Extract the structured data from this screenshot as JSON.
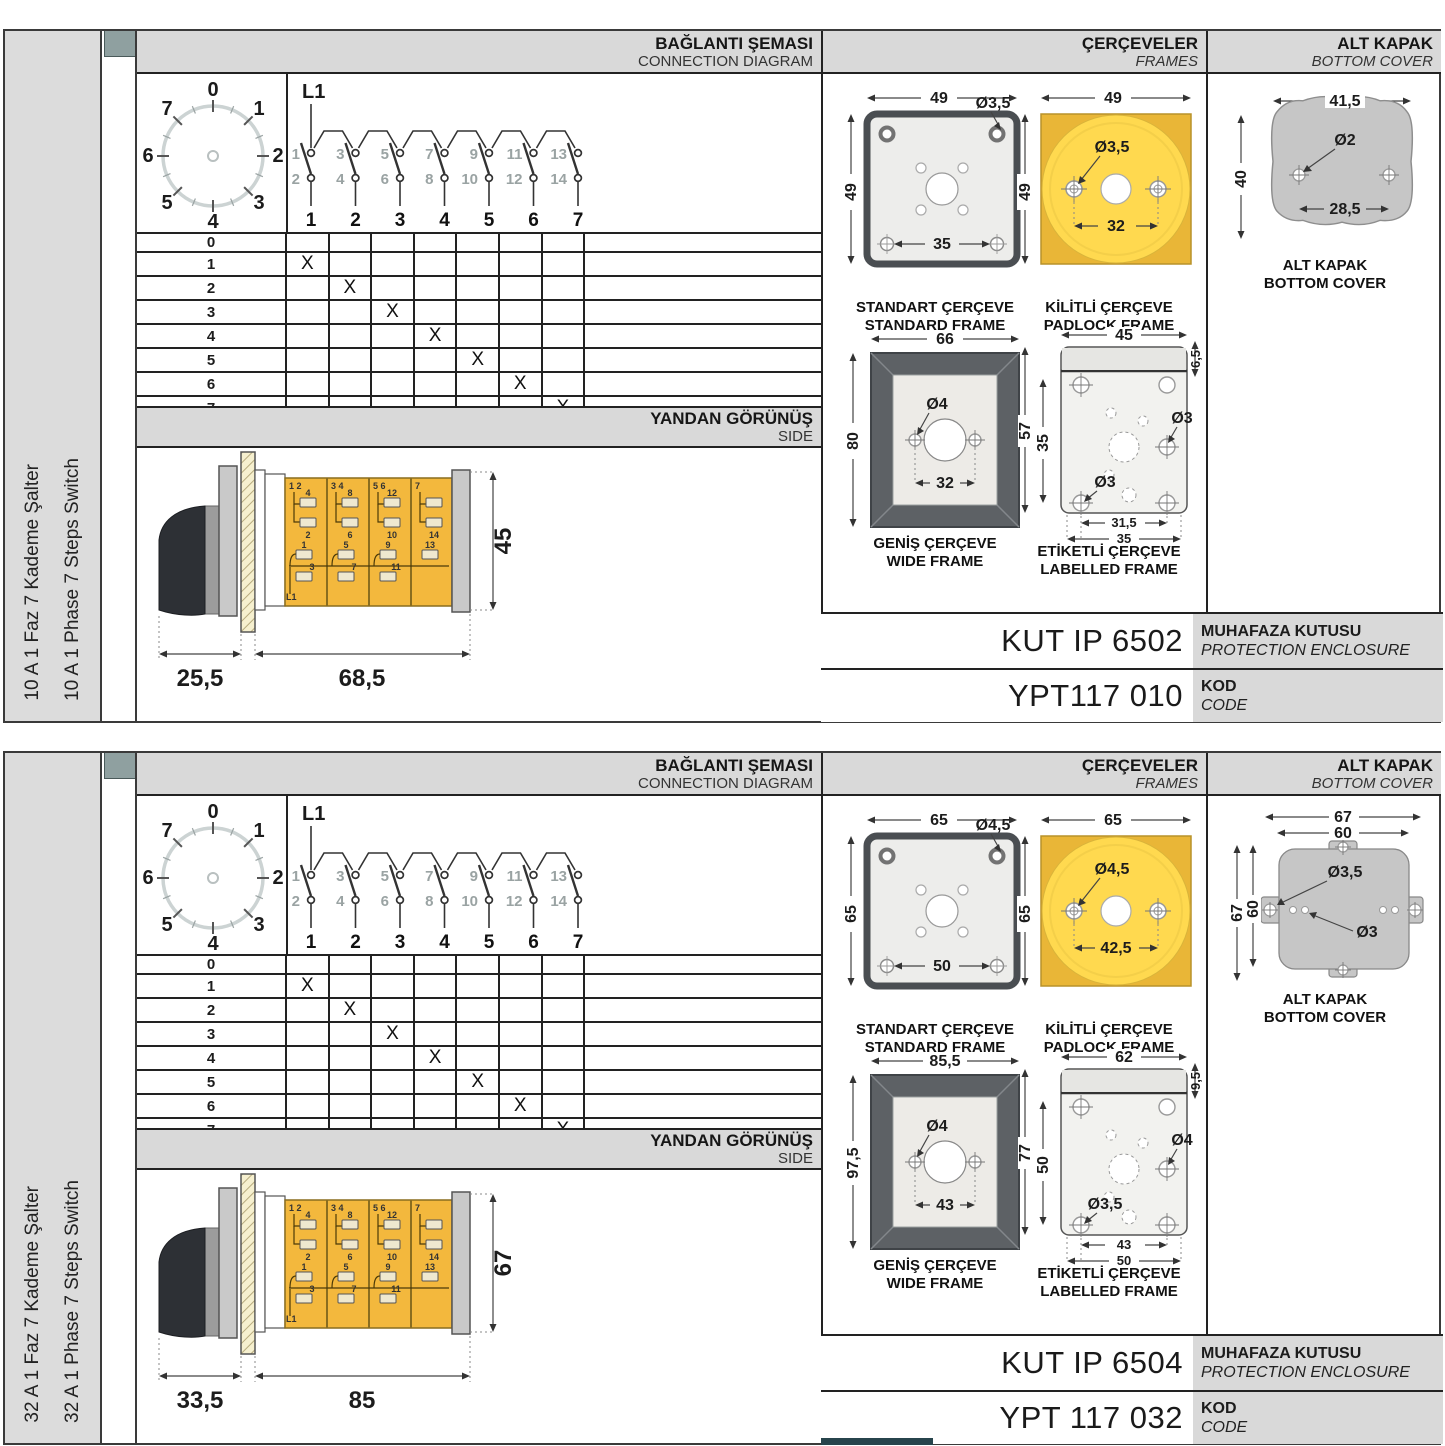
{
  "colors": {
    "header_gray": "#d9d9d9",
    "padlock_yellow": "#efc23a",
    "padlock_circle_yellow": "#ffd94f",
    "switch_body_yellow": "#f3b83d",
    "wide_frame_gray": "#5d6165",
    "cover_gray": "#c6c6c6",
    "tab_square_teal": "#8fa0a0"
  },
  "panels": [
    {
      "side_label_tr": "10 A 1 Faz 7 Kademe Şalter",
      "side_label_en": "10 A 1 Phase 7 Steps Switch",
      "headers": {
        "connection_tr": "BAĞLANTI ŞEMASI",
        "connection_en": "CONNECTION DIAGRAM",
        "frames_tr": "ÇERÇEVELER",
        "frames_en": "FRAMES",
        "cover_tr": "ALT KAPAK",
        "cover_en": "BOTTOM COVER",
        "side_tr": "YANDAN GÖRÜNÜŞ",
        "side_en": "SIDE"
      },
      "dial": {
        "positions": [
          "0",
          "1",
          "2",
          "3",
          "4",
          "5",
          "6",
          "7"
        ]
      },
      "circuit": {
        "feed": "L1",
        "top_terminals": [
          "1",
          "3",
          "5",
          "7",
          "9",
          "11",
          "13"
        ],
        "bottom_terminals": [
          "2",
          "4",
          "6",
          "8",
          "10",
          "12",
          "14"
        ],
        "columns": [
          "1",
          "2",
          "3",
          "4",
          "5",
          "6",
          "7"
        ]
      },
      "table": {
        "rows": [
          "0",
          "1",
          "2",
          "3",
          "4",
          "5",
          "6",
          "7"
        ],
        "mark": "X"
      },
      "side_view": {
        "dim_front": "25,5",
        "dim_body": "68,5",
        "dim_height": "45",
        "feed": "L1",
        "modules_top": [
          {
            "corner": "1 2",
            "upper": "4",
            "lower": "2"
          },
          {
            "corner": "3 4",
            "upper": "8",
            "lower": "6"
          },
          {
            "corner": "5 6",
            "upper": "12",
            "lower": "10"
          },
          {
            "corner": "7",
            "upper": "",
            "lower": "14"
          }
        ],
        "modules_bottom": [
          {
            "upper": "1",
            "lower": "3"
          },
          {
            "upper": "5",
            "lower": "7"
          },
          {
            "upper": "9",
            "lower": "11"
          },
          {
            "upper": "13",
            "lower": ""
          }
        ]
      },
      "standard_frame": {
        "caption_tr": "STANDART ÇERÇEVE",
        "caption_en": "STANDARD FRAME",
        "width": "49",
        "height": "49",
        "hole": "Ø3,5",
        "inner": "35"
      },
      "padlock_frame": {
        "caption_tr": "KİLİTLİ ÇERÇEVE",
        "caption_en": "PADLOCK FRAME",
        "width": "49",
        "height": "49",
        "hole": "Ø3,5",
        "inner": "32"
      },
      "wide_frame": {
        "caption_tr": "GENİŞ ÇERÇEVE",
        "caption_en": "WIDE FRAME",
        "width": "66",
        "height": "80",
        "hole": "Ø4",
        "inner": "32"
      },
      "labelled_frame": {
        "caption_tr": "ETİKETLİ ÇERÇEVE",
        "caption_en": "LABELLED FRAME",
        "width": "45",
        "strip": "6,5",
        "height": "57",
        "inner_height": "35",
        "hole_upper": "Ø3",
        "hole_lower": "Ø3",
        "inner_width": "31,5",
        "outer_width": "35"
      },
      "bottom_cover": {
        "caption_tr": "ALT KAPAK",
        "caption_en": "BOTTOM COVER",
        "width": "41,5",
        "hole": "Ø2",
        "height": "40",
        "inner": "28,5"
      },
      "codes": {
        "enclosure_value": "KUT IP 6502",
        "enclosure_tr": "MUHAFAZA KUTUSU",
        "enclosure_en": "PROTECTION ENCLOSURE",
        "code_value": "YPT117 010",
        "code_tr": "KOD",
        "code_en": "CODE"
      }
    },
    {
      "side_label_tr": "32 A 1 Faz 7 Kademe Şalter",
      "side_label_en": "32 A 1 Phase 7 Steps Switch",
      "headers": {
        "connection_tr": "BAĞLANTI ŞEMASI",
        "connection_en": "CONNECTION DIAGRAM",
        "frames_tr": "ÇERÇEVELER",
        "frames_en": "FRAMES",
        "cover_tr": "ALT KAPAK",
        "cover_en": "BOTTOM COVER",
        "side_tr": "YANDAN GÖRÜNÜŞ",
        "side_en": "SIDE"
      },
      "dial": {
        "positions": [
          "0",
          "1",
          "2",
          "3",
          "4",
          "5",
          "6",
          "7"
        ]
      },
      "circuit": {
        "feed": "L1",
        "top_terminals": [
          "1",
          "3",
          "5",
          "7",
          "9",
          "11",
          "13"
        ],
        "bottom_terminals": [
          "2",
          "4",
          "6",
          "8",
          "10",
          "12",
          "14"
        ],
        "columns": [
          "1",
          "2",
          "3",
          "4",
          "5",
          "6",
          "7"
        ]
      },
      "table": {
        "rows": [
          "0",
          "1",
          "2",
          "3",
          "4",
          "5",
          "6",
          "7"
        ],
        "mark": "X"
      },
      "side_view": {
        "dim_front": "33,5",
        "dim_body": "85",
        "dim_height": "67",
        "feed": "L1",
        "modules_top": [
          {
            "corner": "1 2",
            "upper": "4",
            "lower": "2"
          },
          {
            "corner": "3 4",
            "upper": "8",
            "lower": "6"
          },
          {
            "corner": "5 6",
            "upper": "12",
            "lower": "10"
          },
          {
            "corner": "7",
            "upper": "",
            "lower": "14"
          }
        ],
        "modules_bottom": [
          {
            "upper": "1",
            "lower": "3"
          },
          {
            "upper": "5",
            "lower": "7"
          },
          {
            "upper": "9",
            "lower": "11"
          },
          {
            "upper": "13",
            "lower": ""
          }
        ]
      },
      "standard_frame": {
        "caption_tr": "STANDART ÇERÇEVE",
        "caption_en": "STANDARD FRAME",
        "width": "65",
        "height": "65",
        "hole": "Ø4,5",
        "inner": "50"
      },
      "padlock_frame": {
        "caption_tr": "KİLİTLİ ÇERÇEVE",
        "caption_en": "PADLOCK FRAME",
        "width": "65",
        "height": "65",
        "hole": "Ø4,5",
        "inner": "42,5"
      },
      "wide_frame": {
        "caption_tr": "GENİŞ ÇERÇEVE",
        "caption_en": "WIDE FRAME",
        "width": "85,5",
        "height": "97,5",
        "hole": "Ø4",
        "inner": "43"
      },
      "labelled_frame": {
        "caption_tr": "ETİKETLİ ÇERÇEVE",
        "caption_en": "LABELLED FRAME",
        "width": "62",
        "strip": "9,5",
        "height": "77",
        "inner_height": "50",
        "hole_upper": "Ø4",
        "hole_lower": "Ø3,5",
        "inner_width": "43",
        "outer_width": "50"
      },
      "bottom_cover": {
        "caption_tr": "ALT KAPAK",
        "caption_en": "BOTTOM COVER",
        "width_outer": "67",
        "width_inner": "60",
        "height_outer": "67",
        "height_inner": "60",
        "hole_small": "Ø3,5",
        "hole_tiny": "Ø3"
      },
      "codes": {
        "enclosure_value": "KUT IP 6504",
        "enclosure_tr": "MUHAFAZA KUTUSU",
        "enclosure_en": "PROTECTION ENCLOSURE",
        "code_value": "YPT 117 032",
        "code_tr": "KOD",
        "code_en": "CODE"
      }
    }
  ]
}
